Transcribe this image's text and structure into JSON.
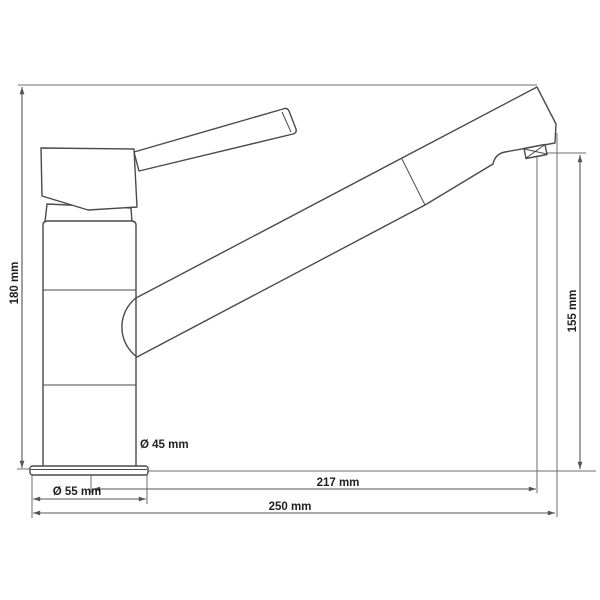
{
  "page": {
    "title": "Kitchen faucet technical dimension drawing",
    "background_color": "#ffffff",
    "outline_color": "#4a4a4a",
    "dimension_line_color": "#555555",
    "label_color": "#1f1f1f"
  },
  "drawing": {
    "type": "technical-dimension-diagram",
    "subject": "single-lever kitchen sink mixer tap, side view",
    "labels": {
      "total_height": "180 mm",
      "outlet_height": "155 mm",
      "body_diameter": "Ø 45 mm",
      "base_diameter": "Ø 55 mm",
      "spout_reach": "217 mm",
      "total_depth": "250 mm"
    }
  }
}
